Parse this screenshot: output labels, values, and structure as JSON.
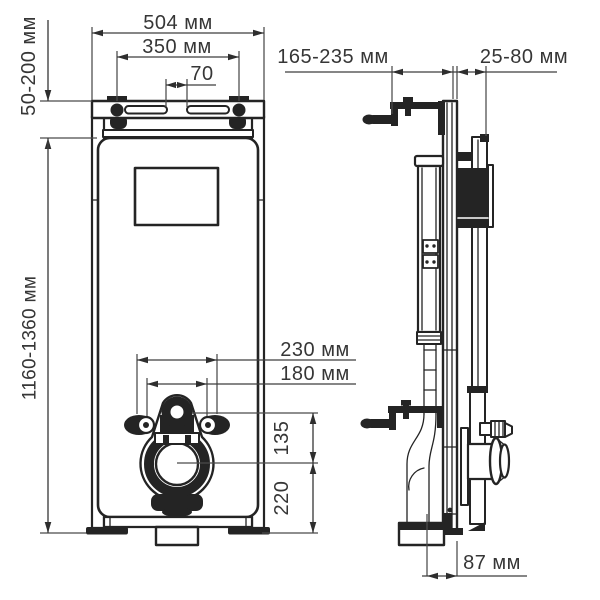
{
  "drawing": {
    "type": "installation-frame-technical-drawing",
    "colors": {
      "ink": "#242424",
      "dimension_lines": "#3d3d3d",
      "background": "#ffffff"
    },
    "dims": {
      "front": {
        "width": "504 мм",
        "hanger_spacing": "350 мм",
        "slot_gap": "70",
        "top_adjust": "50-200 мм",
        "frame_height": "1160-1360 мм",
        "fixing_outer": "230 мм",
        "fixing_inner": "180 мм",
        "drain_offset": "135",
        "drain_height": "220"
      },
      "side": {
        "wall_offset": "165-235 мм",
        "front_depth": "25-80 мм",
        "outlet_offset": "87 мм"
      }
    }
  }
}
